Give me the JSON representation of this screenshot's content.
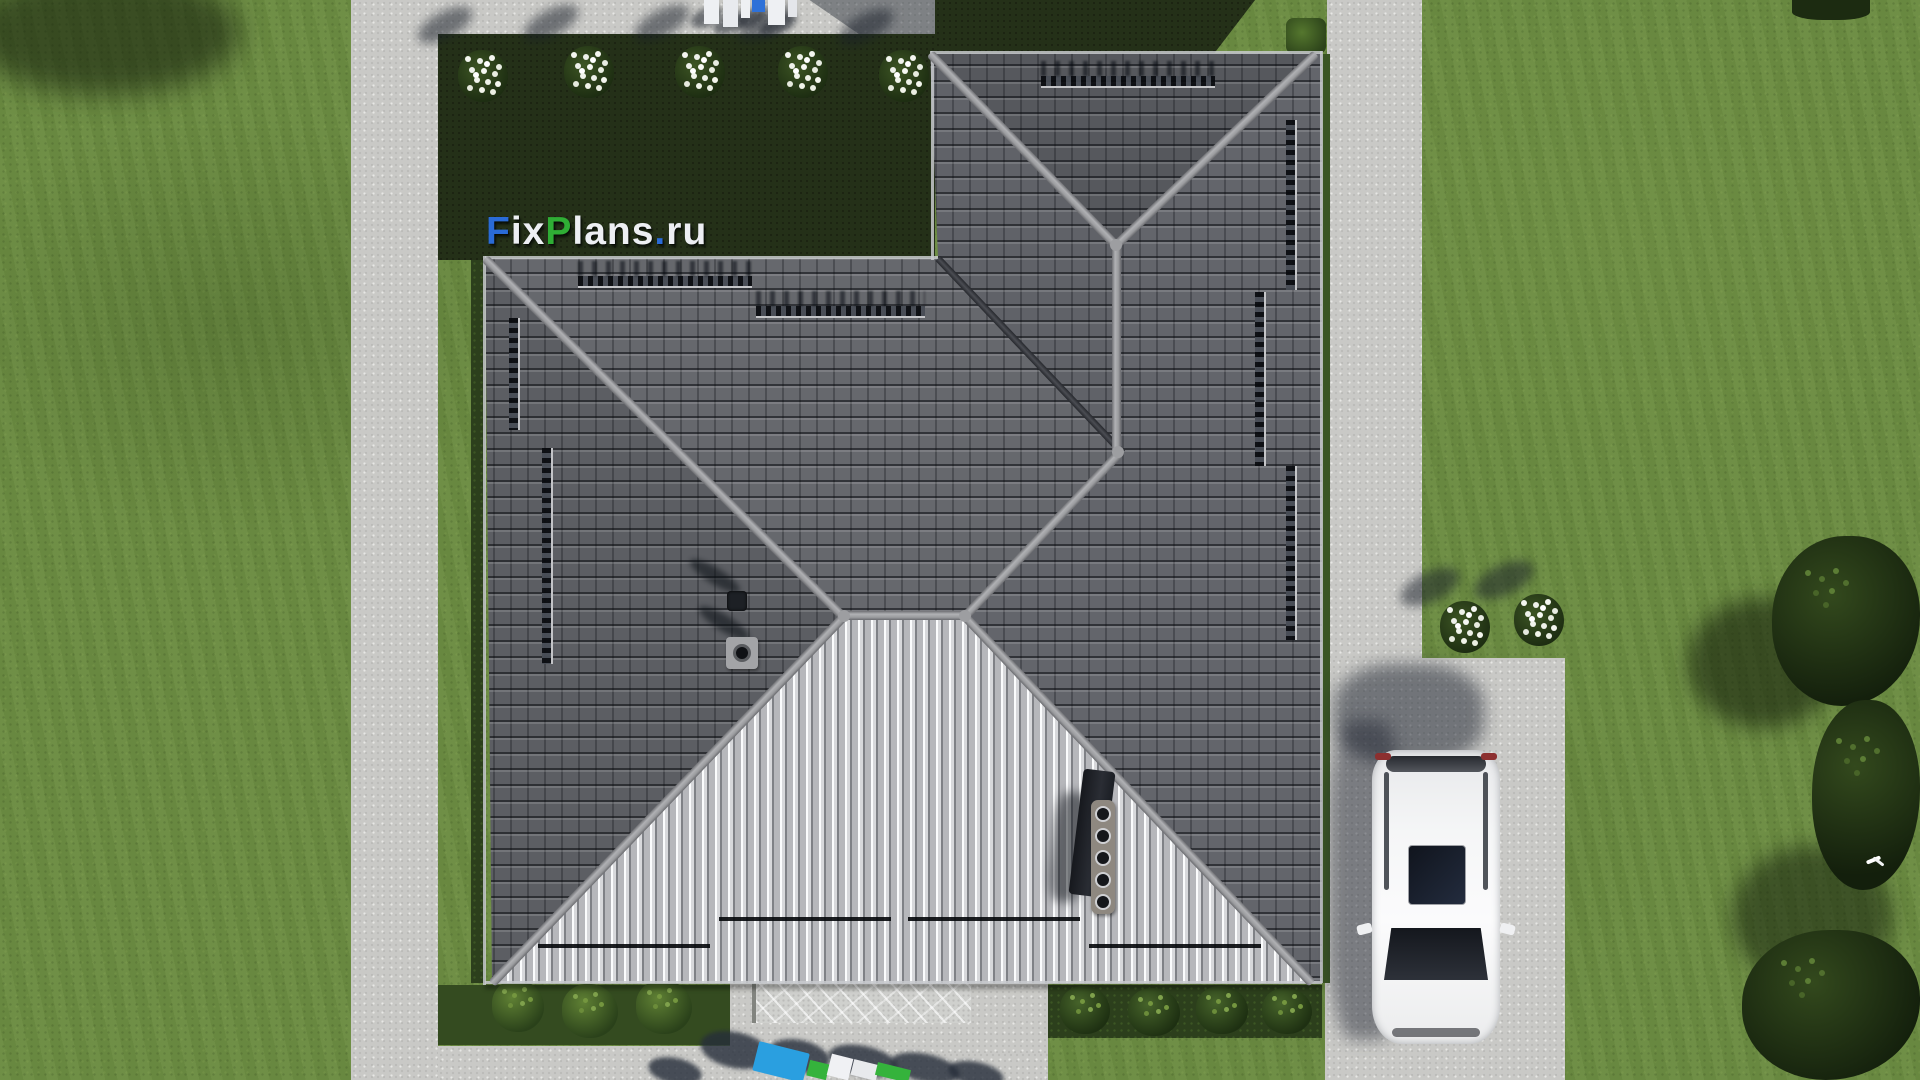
{
  "watermark": {
    "text": "FixPlans.ru",
    "segments": [
      {
        "text": "F",
        "color": "#2a6bd6"
      },
      {
        "text": "ix",
        "color": "#edeff3"
      },
      {
        "text": "P",
        "color": "#2fae35"
      },
      {
        "text": "lans",
        "color": "#edeff3"
      },
      {
        "text": ".",
        "color": "#2a6bd6"
      },
      {
        "text": "ru",
        "color": "#edeff3"
      }
    ]
  },
  "palette": {
    "grass": "#6c8c42",
    "grass_shadow": "#243018",
    "concrete": "#c9c9c6",
    "roof_dark": "#55575c",
    "roof_light": "#b4b5b9",
    "ridge_cap": "#9b9c9f",
    "car_body": "#f3f4f5",
    "logo_blue": "#2a6bd6",
    "logo_green": "#2fae35",
    "logo_white": "#edeff3"
  },
  "objects": {
    "house_roof": "dark grey tiled hip roof, top view",
    "car": "white SUV parked on driveway",
    "flower_beds": "white flowering bushes",
    "trees": "garden trees",
    "bird": "white bird in flight"
  }
}
